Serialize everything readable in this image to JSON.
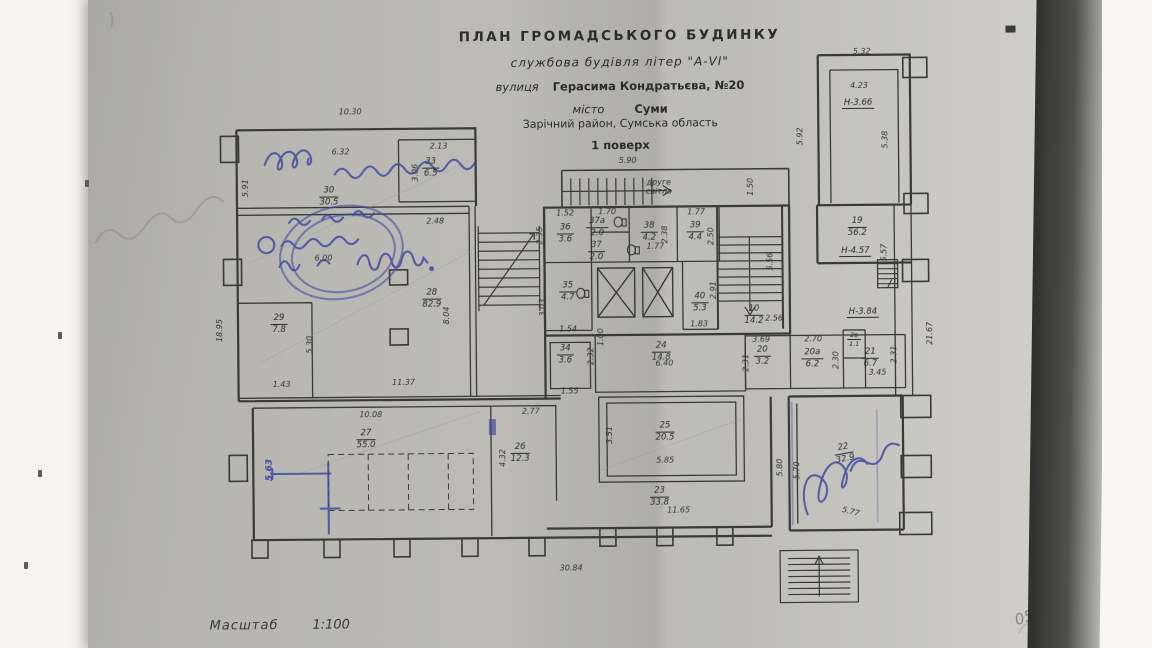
{
  "title_block": {
    "line1": "ПЛАН  ГРОМАДСЬКОГО  БУДИНКУ",
    "line2": "службова будівля літер \"А-VІ\"",
    "line3_label": "вулиця",
    "line3_value": "Герасима Кондратьєва, №20",
    "line4_label": "місто",
    "line4_value": "Суми",
    "line5": "Зарічний район, Сумська область",
    "line6": "1 поверх"
  },
  "scale": {
    "label": "Масштаб",
    "value": "1:100"
  },
  "notes": {
    "second_light_1": "друге",
    "second_light_2": "світло",
    "corner_mark": "05"
  },
  "heights": {
    "h_366": "Н-3.66",
    "h_457": "Н-4.57",
    "h_384": "Н-3.84"
  },
  "rooms": {
    "r30": {
      "num": "30",
      "area": "30.5"
    },
    "r33": {
      "num": "33",
      "area": "6.5"
    },
    "r28": {
      "num": "28",
      "area": "82.9"
    },
    "r29": {
      "num": "29",
      "area": "7.8"
    },
    "r27": {
      "num": "27",
      "area": "55.0"
    },
    "r26": {
      "num": "26",
      "area": "12.3"
    },
    "r36": {
      "num": "36",
      "area": "3.6"
    },
    "r37a": {
      "num": "37а",
      "area": "2.0"
    },
    "r37": {
      "num": "37",
      "area": "2.0"
    },
    "r38": {
      "num": "38",
      "area": "4.2"
    },
    "r39": {
      "num": "39",
      "area": "4.4"
    },
    "r35": {
      "num": "35",
      "area": "4.7"
    },
    "r40": {
      "num": "40",
      "area": "5.3"
    },
    "r34": {
      "num": "34",
      "area": "3.6"
    },
    "r24": {
      "num": "24",
      "area": "14.8"
    },
    "r25": {
      "num": "25",
      "area": "20.5"
    },
    "r23": {
      "num": "23",
      "area": "33.8"
    },
    "r20": {
      "num": "20",
      "area": "3.2"
    },
    "r20a": {
      "num": "20а",
      "area": "6.2"
    },
    "r2v": {
      "num": "2в",
      "area": "1.1"
    },
    "r21": {
      "num": "21",
      "area": "6.7"
    },
    "r10": {
      "num": "10",
      "area": "14.2"
    },
    "r19": {
      "num": "19",
      "area": "56.2"
    },
    "r22": {
      "num": "22",
      "area": "32.9"
    }
  },
  "dims": {
    "d10_30": "10.30",
    "d6_32": "6.32",
    "d2_13": "2.13",
    "d3_06": "3.06",
    "d2_48": "2.48",
    "d6_00": "6.00",
    "d5_91": "5.91",
    "d18_95": "18.95",
    "d5_30": "5.30",
    "d8_04": "8.04",
    "d11_37": "11.37",
    "d1_43": "1.43",
    "d10_08": "10.08",
    "d5_63": "5.63",
    "d2_77": "2.77",
    "d4_32": "4.32",
    "d5_90": "5.90",
    "d1_50": "1.50",
    "d1_52": "1.52",
    "d1_70": "1.70",
    "d1_77": "1.77",
    "d2_35": "2.35",
    "d3_03": "3.03",
    "d1_54": "1.54",
    "d2_38": "2.38",
    "d2_50": "2.50",
    "d2_91": "2.91",
    "d1_83": "1.83",
    "d2_56": "2.56",
    "d5_56": "5.56",
    "d5_57": "5.57",
    "d5_92": "5.92",
    "d5_32": "5.32",
    "d4_23": "4.23",
    "d5_38": "5.38",
    "d21_67": "21.67",
    "d2_32": "2.32",
    "d1_00": "1.00",
    "d1_55": "1.55",
    "d6_40": "6.40",
    "d2_31": "2.31",
    "d3_69": "3.69",
    "d2_70": "2.70",
    "d2_30": "2.30",
    "d3_45": "3.45",
    "d3_51": "3.51",
    "d5_85": "5.85",
    "d11_65": "11.65",
    "d5_80": "5.80",
    "d5_70": "5.70",
    "d5_77": "5.77",
    "d30_84": "30.84"
  },
  "colors": {
    "paper": "#bcbbb5",
    "ink": "#34342f",
    "pen_blue": "#3d47a0"
  }
}
